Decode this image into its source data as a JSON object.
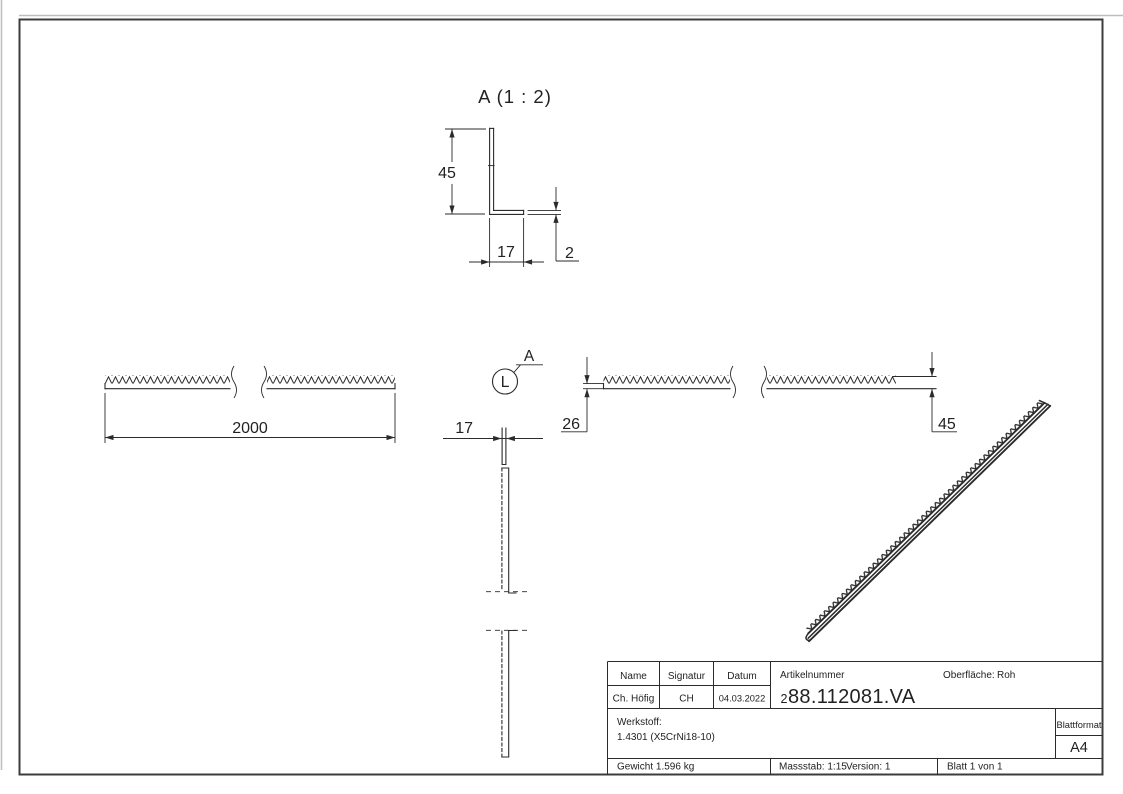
{
  "colors": {
    "line": "#2b2b2b",
    "text": "#222222",
    "frame": "#3c3c3c",
    "background": "#ffffff"
  },
  "detail_view": {
    "title": "A (1 : 2)",
    "height": "45",
    "width": "17",
    "thickness": "2"
  },
  "front_view": {
    "length": "2000"
  },
  "top_view": {
    "width": "17"
  },
  "right_view": {
    "left_height": "26",
    "right_height": "45"
  },
  "callout": {
    "circle_label": "L",
    "detail_label": "A"
  },
  "title_block": {
    "name_header": "Name",
    "signature_header": "Signatur",
    "date_header": "Datum",
    "name": "Ch. Höfig",
    "signature": "CH",
    "date": "04.03.2022",
    "article_label": "Artikelnummer",
    "article_prefix": "2",
    "article_number": "88.112081.VA",
    "surface_label": "Oberfläche:",
    "surface_value": "Roh",
    "material_label": "Werkstoff:",
    "material_value": "1.4301 (X5CrNi18-10)",
    "weight": "Gewicht 1.596 kg",
    "scale": "Massstab: 1:15",
    "version": "Version: 1",
    "sheet_info": "Blatt 1 von 1",
    "format_label": "Blattformat",
    "format_value": "A4"
  }
}
